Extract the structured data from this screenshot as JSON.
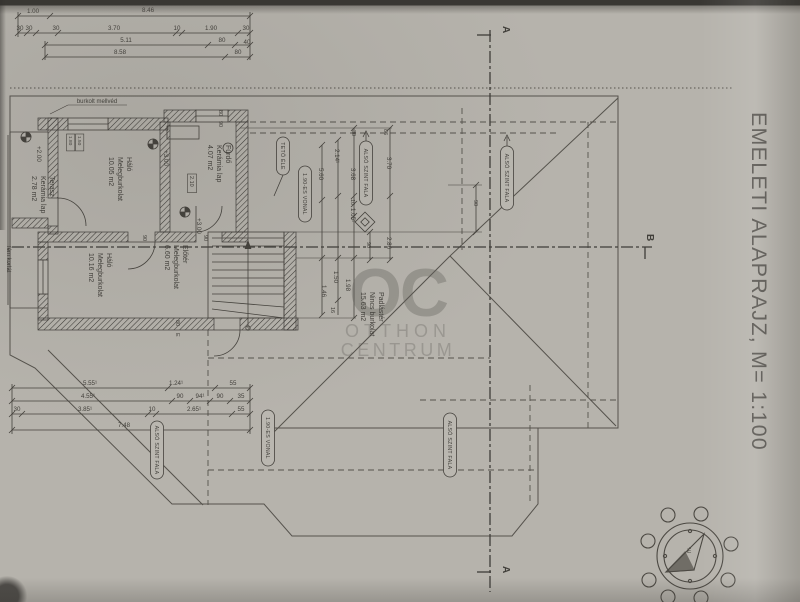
{
  "title": "EMELETI ALAPRAJZ, M= 1:100",
  "watermark": {
    "initials": "OC",
    "line1": "OTTHON",
    "line2": "CENTRUM"
  },
  "compass": {
    "north_letter": "É"
  },
  "rooms": [
    {
      "lines": [
        "Terasz",
        "Kerámia lap",
        "2.78 m2"
      ],
      "x": 50,
      "y": 176,
      "s": 7
    },
    {
      "lines": [
        "Háló",
        "Melegburkolat",
        "10.05 m2"
      ],
      "x": 127,
      "y": 157,
      "s": 7
    },
    {
      "lines": [
        "Fürdő",
        "Kerámia lap",
        "4.07 m2"
      ],
      "x": 226,
      "y": 145,
      "s": 7
    },
    {
      "lines": [
        "Háló",
        "Melegburkolat",
        "10.16 m2"
      ],
      "x": 107,
      "y": 253,
      "s": 7
    },
    {
      "lines": [
        "Előtér",
        "Melegburkolat",
        "6.60 m2"
      ],
      "x": 183,
      "y": 245,
      "s": 7
    },
    {
      "lines": [
        "Padlástér",
        "Nincs burkolat",
        "15.63 m2"
      ],
      "x": 379,
      "y": 292,
      "s": 7
    }
  ],
  "pills": [
    {
      "t": "TETŐ ÉLE",
      "x": 283,
      "cy": 156,
      "h": 38
    },
    {
      "t": "1.90-ES VONAL",
      "x": 305,
      "cy": 194,
      "h": 56
    },
    {
      "t": "ALSÓ SZINT FALA",
      "x": 366,
      "cy": 173,
      "h": 64
    },
    {
      "t": "ALSÓ SZINT FALA",
      "x": 507,
      "cy": 178,
      "h": 64
    },
    {
      "t": "ALSÓ SZINT FALA",
      "x": 157,
      "cy": 450,
      "h": 58
    },
    {
      "t": "1.90-ES VONAL",
      "x": 268,
      "cy": 438,
      "h": 56
    },
    {
      "t": "ALSÓ SZINT FALA",
      "x": 450,
      "cy": 445,
      "h": 64
    }
  ],
  "labels": [
    {
      "t": "1.00",
      "x": 33,
      "y": 13
    },
    {
      "t": "8.46",
      "x": 148,
      "y": 12
    },
    {
      "t": "30",
      "x": 20,
      "y": 30
    },
    {
      "t": "30",
      "x": 29,
      "y": 30
    },
    {
      "t": "30",
      "x": 56,
      "y": 30
    },
    {
      "t": "3.70",
      "x": 114,
      "y": 30
    },
    {
      "t": "10",
      "x": 177,
      "y": 30
    },
    {
      "t": "1.90",
      "x": 211,
      "y": 30
    },
    {
      "t": "30",
      "x": 246,
      "y": 30
    },
    {
      "t": "5.11",
      "x": 126,
      "y": 42
    },
    {
      "t": "80",
      "x": 222,
      "y": 42
    },
    {
      "t": "40",
      "x": 247,
      "y": 44
    },
    {
      "t": "8.58",
      "x": 120,
      "y": 54
    },
    {
      "t": "80",
      "x": 238,
      "y": 54
    },
    {
      "t": "burkolt mellvéd",
      "x": 97,
      "y": 103,
      "s": 6
    },
    {
      "t": "fém korlát",
      "x": 7,
      "y": 246,
      "r": 90,
      "s": 6
    },
    {
      "t": "+2.00",
      "x": 37,
      "y": 146,
      "r": 90,
      "s": 6.3
    },
    {
      "t": "+3.00",
      "x": 164,
      "y": 150,
      "r": 90,
      "s": 6.3
    },
    {
      "t": "+3.00",
      "x": 197,
      "y": 218,
      "r": 90,
      "s": 6.3
    },
    {
      "t": "1.80",
      "x": 69,
      "y": 136,
      "r": 90,
      "s": 4.8,
      "box": 1
    },
    {
      "t": "1.50",
      "x": 78,
      "y": 136,
      "r": 90,
      "s": 4.8,
      "box": 1
    },
    {
      "t": "80",
      "x": 219,
      "y": 110,
      "r": 90,
      "s": 5.5
    },
    {
      "t": "90",
      "x": 219,
      "y": 121,
      "r": 90,
      "s": 5.5
    },
    {
      "t": "2.10",
      "x": 190,
      "y": 176,
      "r": 90,
      "s": 5.5,
      "box": 1
    },
    {
      "t": "90",
      "x": 143,
      "y": 235,
      "r": 90,
      "s": 5.5
    },
    {
      "t": "90",
      "x": 204,
      "y": 235,
      "r": 90,
      "s": 5.5
    },
    {
      "t": "80",
      "x": 176,
      "y": 320,
      "r": 90,
      "s": 5.5
    },
    {
      "t": "E",
      "x": 176,
      "y": 333,
      "r": 90,
      "s": 5.5
    },
    {
      "t": "30",
      "x": 352,
      "y": 130,
      "r": 90,
      "s": 5.5
    },
    {
      "t": "86",
      "x": 384,
      "y": 129,
      "r": 90,
      "s": 5.5
    },
    {
      "t": "2.14¹",
      "x": 335,
      "y": 149,
      "r": 90
    },
    {
      "t": "5.60",
      "x": 319,
      "y": 168,
      "r": 90
    },
    {
      "t": "3.68",
      "x": 351,
      "y": 168,
      "r": 90
    },
    {
      "t": "3.70",
      "x": 387,
      "y": 157,
      "r": 90
    },
    {
      "t": "10",
      "x": 351,
      "y": 199,
      "r": 90,
      "s": 5.5
    },
    {
      "t": "1.05¹",
      "x": 351,
      "y": 208,
      "r": 90
    },
    {
      "t": "90",
      "x": 367,
      "y": 242,
      "r": 90,
      "s": 5.5
    },
    {
      "t": "2.86",
      "x": 387,
      "y": 237,
      "r": 90
    },
    {
      "t": "90",
      "x": 474,
      "y": 200,
      "r": 90,
      "s": 5.5
    },
    {
      "t": "1.50",
      "x": 334,
      "y": 271,
      "r": 90
    },
    {
      "t": "1.98",
      "x": 346,
      "y": 279,
      "r": 90
    },
    {
      "t": "1.46",
      "x": 322,
      "y": 285,
      "r": 90
    },
    {
      "t": "16",
      "x": 331,
      "y": 307,
      "r": 90,
      "s": 5.5
    },
    {
      "t": "5.55¹",
      "x": 90,
      "y": 385
    },
    {
      "t": "1.24¹",
      "x": 176,
      "y": 385
    },
    {
      "t": "55",
      "x": 233,
      "y": 385
    },
    {
      "t": "4.55¹",
      "x": 88,
      "y": 398
    },
    {
      "t": "90",
      "x": 180,
      "y": 398
    },
    {
      "t": "94¹",
      "x": 200,
      "y": 398
    },
    {
      "t": "90",
      "x": 220,
      "y": 398
    },
    {
      "t": "35",
      "x": 241,
      "y": 398
    },
    {
      "t": "30",
      "x": 17,
      "y": 411
    },
    {
      "t": "3.85¹",
      "x": 85,
      "y": 411
    },
    {
      "t": "10",
      "x": 152,
      "y": 411
    },
    {
      "t": "2.65¹",
      "x": 194,
      "y": 411
    },
    {
      "t": "55",
      "x": 241,
      "y": 411
    },
    {
      "t": "7.48",
      "x": 124,
      "y": 427
    },
    {
      "t": "A",
      "x": 503,
      "y": 26,
      "r": 90,
      "s": 10,
      "b": 1
    },
    {
      "t": "A",
      "x": 503,
      "y": 566,
      "r": 90,
      "s": 10,
      "b": 1
    },
    {
      "t": "B",
      "x": 647,
      "y": 234,
      "r": 90,
      "s": 10,
      "b": 1
    }
  ]
}
